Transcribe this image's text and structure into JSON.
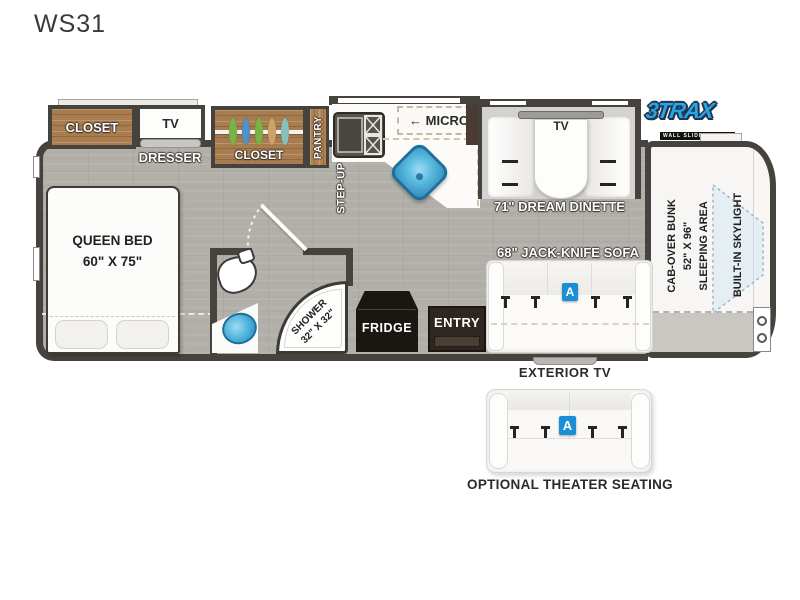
{
  "title": "WS31",
  "logo": {
    "brand": "3TRAX",
    "tagline": "WALL SLIDE SYSTEM",
    "color": "#2aa3e2"
  },
  "bedroom": {
    "closet": "CLOSET",
    "tv": "TV",
    "dresser": "DRESSER",
    "queen_bed_line1": "QUEEN BED",
    "queen_bed_line2": "60\" X 75\""
  },
  "hall": {
    "closet": "CLOSET",
    "pantry": "PANTRY",
    "step_up": "STEP-UP"
  },
  "kitchen": {
    "micro_arrow": "←",
    "micro": "MICRO",
    "fridge": "FRIDGE"
  },
  "bathroom": {
    "shower_line1": "SHOWER",
    "shower_line2": "32\" X 32\""
  },
  "dinette": {
    "tv": "TV",
    "label": "71\" DREAM DINETTE"
  },
  "living": {
    "sofa_label": "68\" JACK-KNIFE SOFA",
    "sofa_badge": "A",
    "entry": "ENTRY",
    "exterior_tv": "EXTERIOR TV"
  },
  "cab": {
    "bunk_line1": "CAB-OVER BUNK",
    "bunk_line2": "52\" X 96\"",
    "bunk_line3": "SLEEPING AREA",
    "skylight": "BUILT-IN SKYLIGHT"
  },
  "optional_seating": {
    "label": "OPTIONAL THEATER SEATING",
    "badge": "A"
  },
  "colors": {
    "wall": "#46423e",
    "floor": "#b2afa9",
    "wood": "#a87c4e",
    "accent_blue": "#1b8ed6",
    "sink_blue": "#49b0dd",
    "logo_blue": "#2aa3e2"
  }
}
